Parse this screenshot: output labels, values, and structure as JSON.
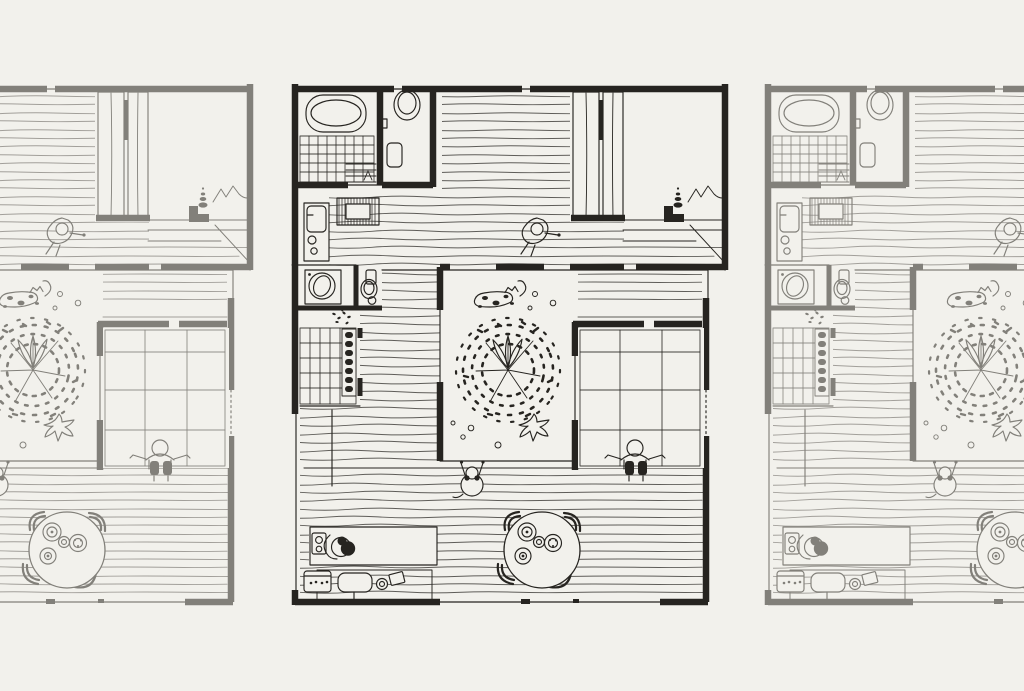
{
  "scene": {
    "description": "Hand-drawn top-view floor plan of a courtyard house with bathroom, toilet, bedroom with closets, entry, kitchen corridor, central courtyard with tree, tatami room and dining area; shown as a three-panel horizontal strip with the center panel in dark ink and the side panels faded and cropped at the screen edges.",
    "colors": {
      "bg": "#f2f1ec",
      "ink": "#262420",
      "faded": "#82807a"
    },
    "slides": [
      {
        "position": "left",
        "state": "faded",
        "visible_part": "right portion, cropped by screen edge"
      },
      {
        "position": "center",
        "state": "active",
        "visible_part": "full plan"
      },
      {
        "position": "right",
        "state": "faded",
        "visible_part": "left portion, cropped by screen edge"
      }
    ]
  }
}
